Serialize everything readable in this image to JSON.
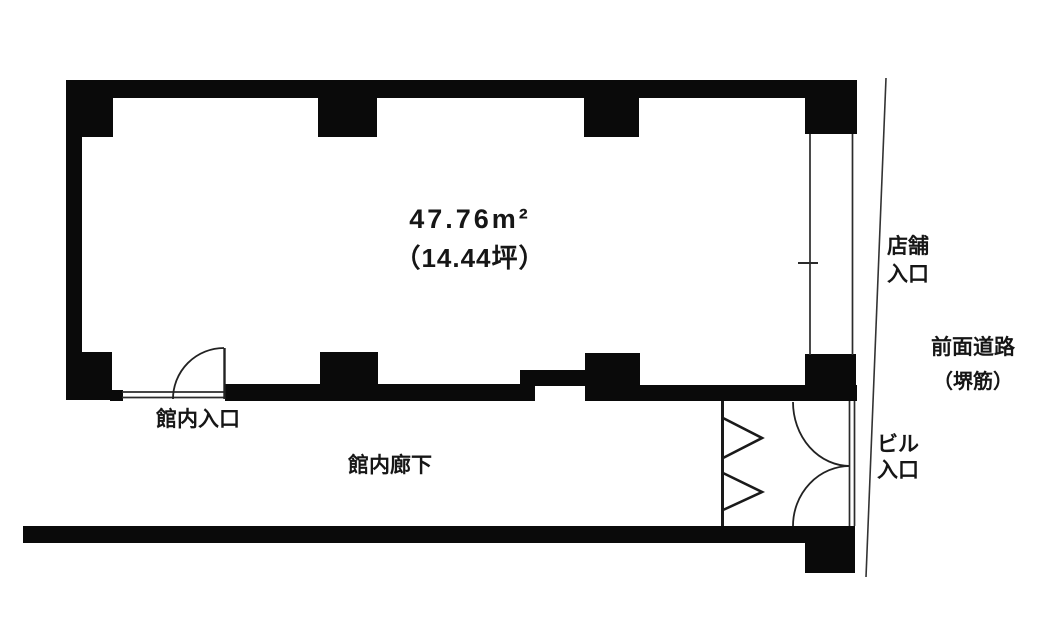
{
  "floor_plan": {
    "area": {
      "line1": "47.76m²",
      "line2": "（14.44坪）"
    },
    "labels": {
      "store_entrance": "店舗\n入口",
      "front_road": "前面道路",
      "road_name": "（堺筋）",
      "building_entrance": "ビル\n入口",
      "hall_entrance": "館内入口",
      "hall_corridor": "館内廊下"
    },
    "colors": {
      "wall": "#0a0a0a",
      "thin_line": "#2b2b2b",
      "background": "#ffffff"
    }
  }
}
